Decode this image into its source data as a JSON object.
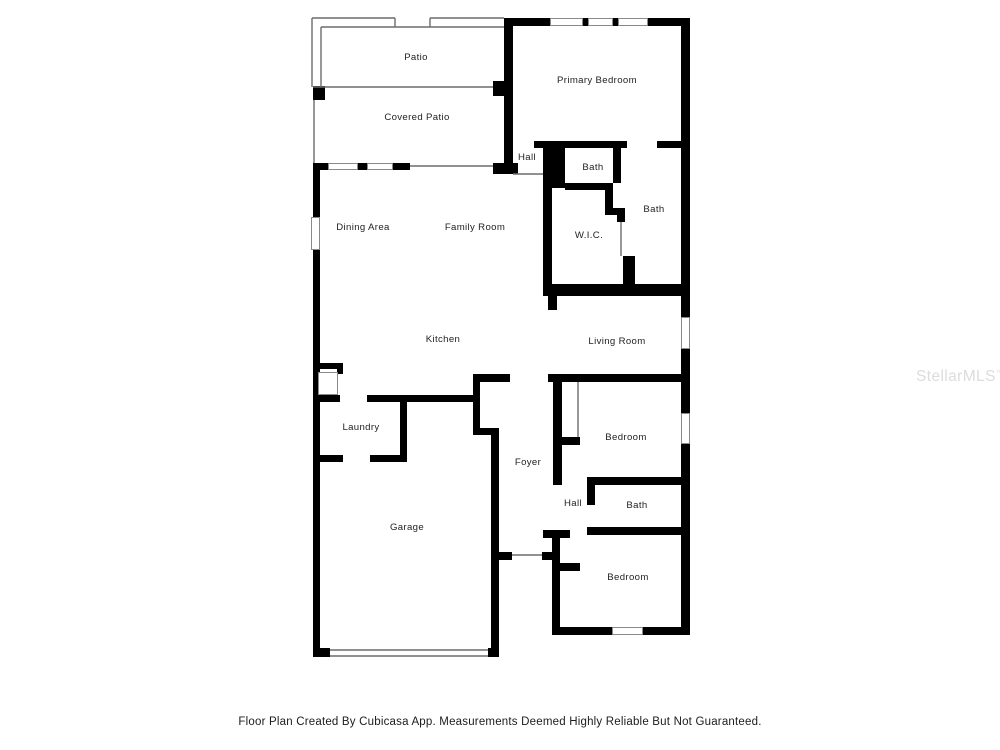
{
  "watermark": {
    "text": "StellarMLS",
    "tm": "™"
  },
  "footer": {
    "text": "Floor Plan Created By Cubicasa App. Measurements Deemed Highly Reliable But Not Guaranteed."
  },
  "floor_plan": {
    "wall_color": "#000000",
    "thin_color": "#6b6b6b",
    "window_border": "#8a8a8a",
    "label_color": "#222222",
    "rooms": [
      {
        "label": "Patio",
        "x": 416,
        "y": 60
      },
      {
        "label": "Covered Patio",
        "x": 417,
        "y": 120
      },
      {
        "label": "Primary Bedroom",
        "x": 597,
        "y": 83
      },
      {
        "label": "Hall",
        "x": 527,
        "y": 160
      },
      {
        "label": "Bath",
        "x": 593,
        "y": 170
      },
      {
        "label": "Bath",
        "x": 654,
        "y": 212
      },
      {
        "label": "W.I.C.",
        "x": 589,
        "y": 238
      },
      {
        "label": "Dining Area",
        "x": 363,
        "y": 230
      },
      {
        "label": "Family Room",
        "x": 475,
        "y": 230
      },
      {
        "label": "Kitchen",
        "x": 443,
        "y": 342
      },
      {
        "label": "Living Room",
        "x": 617,
        "y": 344
      },
      {
        "label": "Laundry",
        "x": 361,
        "y": 430
      },
      {
        "label": "Foyer",
        "x": 528,
        "y": 465
      },
      {
        "label": "Bedroom",
        "x": 626,
        "y": 440
      },
      {
        "label": "Hall",
        "x": 573,
        "y": 506
      },
      {
        "label": "Bath",
        "x": 637,
        "y": 508
      },
      {
        "label": "Garage",
        "x": 407,
        "y": 530
      },
      {
        "label": "Bedroom",
        "x": 628,
        "y": 580
      }
    ],
    "walls": [
      [
        506,
        18,
        44,
        8
      ],
      [
        583,
        18,
        5,
        8
      ],
      [
        613,
        18,
        5,
        8
      ],
      [
        648,
        18,
        42,
        8
      ],
      [
        504,
        18,
        9,
        145
      ],
      [
        681,
        18,
        9,
        278
      ],
      [
        493,
        81,
        20,
        15
      ],
      [
        313,
        86,
        12,
        14
      ],
      [
        493,
        163,
        25,
        11
      ],
      [
        534,
        141,
        31,
        7
      ],
      [
        565,
        141,
        62,
        7
      ],
      [
        657,
        141,
        24,
        7
      ],
      [
        543,
        148,
        22,
        40
      ],
      [
        613,
        147,
        8,
        36
      ],
      [
        565,
        183,
        48,
        7
      ],
      [
        605,
        183,
        8,
        32
      ],
      [
        605,
        208,
        20,
        7
      ],
      [
        617,
        208,
        8,
        14
      ],
      [
        623,
        256,
        12,
        34
      ],
      [
        543,
        188,
        9,
        102
      ],
      [
        543,
        284,
        147,
        12
      ],
      [
        548,
        296,
        9,
        14
      ],
      [
        313,
        163,
        15,
        7
      ],
      [
        358,
        163,
        9,
        7
      ],
      [
        393,
        163,
        17,
        7
      ],
      [
        313,
        163,
        7,
        54
      ],
      [
        313,
        250,
        7,
        113
      ],
      [
        313,
        363,
        30,
        6
      ],
      [
        337,
        363,
        6,
        11
      ],
      [
        313,
        369,
        7,
        86
      ],
      [
        313,
        462,
        7,
        186
      ],
      [
        313,
        648,
        17,
        9
      ],
      [
        488,
        648,
        11,
        9
      ],
      [
        313,
        395,
        27,
        7
      ],
      [
        367,
        395,
        113,
        7
      ],
      [
        400,
        395,
        7,
        67
      ],
      [
        313,
        455,
        30,
        7
      ],
      [
        370,
        455,
        37,
        7
      ],
      [
        473,
        374,
        7,
        61
      ],
      [
        473,
        374,
        37,
        8
      ],
      [
        473,
        428,
        24,
        7
      ],
      [
        491,
        428,
        8,
        229
      ],
      [
        492,
        552,
        20,
        8
      ],
      [
        542,
        552,
        18,
        8
      ],
      [
        548,
        374,
        142,
        8
      ],
      [
        553,
        374,
        9,
        111
      ],
      [
        553,
        437,
        27,
        8
      ],
      [
        587,
        477,
        103,
        8
      ],
      [
        587,
        477,
        8,
        28
      ],
      [
        587,
        527,
        103,
        8
      ],
      [
        543,
        530,
        27,
        8
      ],
      [
        552,
        538,
        8,
        97
      ],
      [
        560,
        563,
        20,
        8
      ],
      [
        552,
        627,
        60,
        8
      ],
      [
        643,
        627,
        47,
        8
      ],
      [
        681,
        296,
        9,
        21
      ],
      [
        681,
        349,
        9,
        64
      ],
      [
        681,
        444,
        9,
        191
      ]
    ],
    "windows": [
      [
        550,
        18,
        33,
        8
      ],
      [
        588,
        18,
        25,
        8
      ],
      [
        618,
        18,
        30,
        8
      ],
      [
        328,
        163,
        30,
        7
      ],
      [
        367,
        163,
        26,
        7
      ],
      [
        311,
        217,
        9,
        33
      ],
      [
        681,
        317,
        9,
        32
      ],
      [
        681,
        413,
        9,
        31
      ],
      [
        612,
        627,
        31,
        8
      ],
      [
        318,
        372,
        20,
        23
      ]
    ],
    "thin_lines": [
      [
        312,
        18,
        395,
        18
      ],
      [
        430,
        18,
        504,
        18
      ],
      [
        312,
        18,
        312,
        87
      ],
      [
        395,
        18,
        395,
        27
      ],
      [
        430,
        18,
        430,
        27
      ],
      [
        321,
        27,
        504,
        27
      ],
      [
        321,
        27,
        321,
        87
      ],
      [
        313,
        87,
        493,
        87
      ],
      [
        314,
        100,
        314,
        163
      ],
      [
        410,
        166,
        493,
        166
      ],
      [
        513,
        174,
        543,
        174
      ],
      [
        621,
        222,
        621,
        256
      ],
      [
        578,
        382,
        578,
        437
      ],
      [
        512,
        555,
        542,
        555
      ],
      [
        330,
        650,
        488,
        650
      ],
      [
        330,
        656,
        488,
        656
      ]
    ]
  }
}
